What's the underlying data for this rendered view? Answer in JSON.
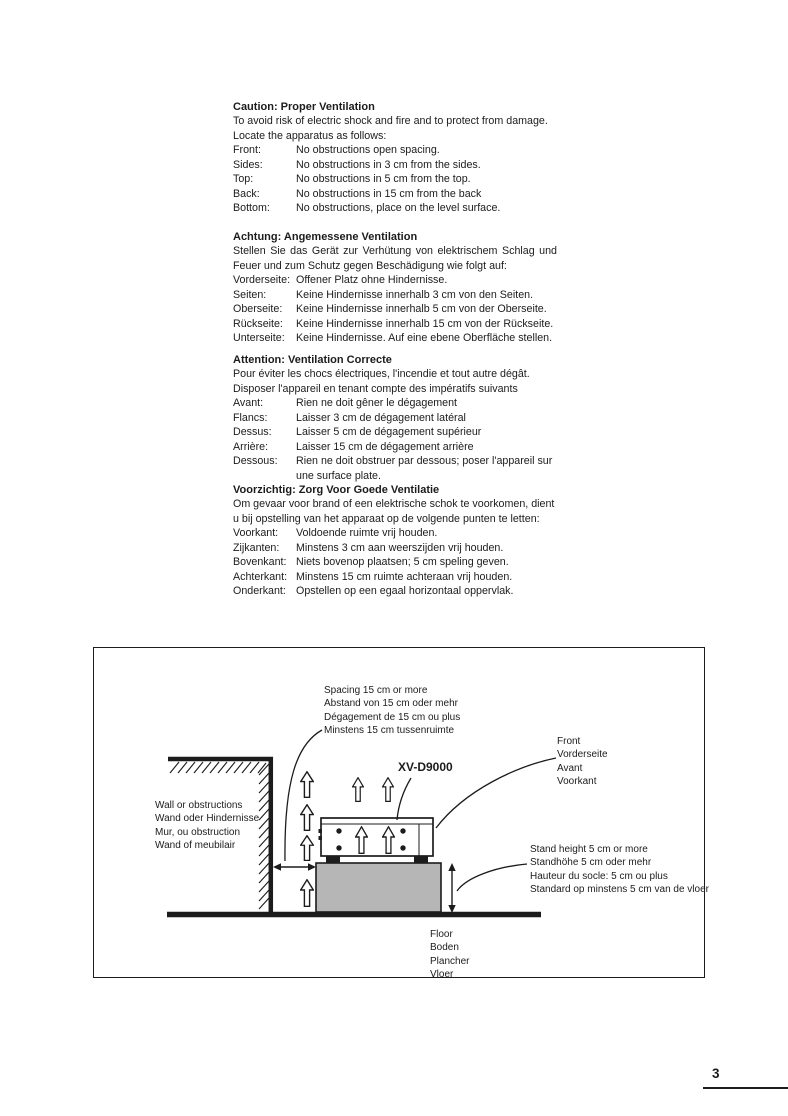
{
  "page": {
    "number": "3"
  },
  "sections": [
    {
      "heading": "Caution: Proper Ventilation",
      "intro": [
        "To avoid risk of electric shock and fire and to protect from damage.",
        "Locate the apparatus as follows:"
      ],
      "rows": [
        {
          "label": "Front:",
          "text": "No obstructions open spacing."
        },
        {
          "label": "Sides:",
          "text": "No obstructions in 3 cm from the sides."
        },
        {
          "label": "Top:",
          "text": "No obstructions in 5 cm from the top."
        },
        {
          "label": "Back:",
          "text": "No obstructions in 15 cm from the back"
        },
        {
          "label": "Bottom:",
          "text": "No obstructions, place on the level surface."
        }
      ]
    },
    {
      "heading": "Achtung: Angemessene Ventilation",
      "intro": [
        "Stellen Sie das Gerät zur Verhütung von elektrischem Schlag und",
        "Feuer und zum Schutz gegen Beschädigung wie folgt auf:"
      ],
      "rows": [
        {
          "label": "Vorderseite:",
          "text": "Offener Platz ohne Hindernisse."
        },
        {
          "label": "Seiten:",
          "text": "Keine Hindernisse innerhalb 3 cm von den Seiten."
        },
        {
          "label": "Oberseite:",
          "text": "Keine Hindernisse innerhalb 5 cm von der Oberseite."
        },
        {
          "label": "Rückseite:",
          "text": "Keine Hindernisse innerhalb 15 cm von der Rückseite."
        },
        {
          "label": "Unterseite:",
          "text": "Keine Hindernisse.  Auf eine ebene Oberfläche stellen."
        }
      ]
    },
    {
      "heading": "Attention: Ventilation Correcte",
      "intro": [
        "Pour éviter les chocs électriques, l'incendie et tout autre dégât.",
        "Disposer l'appareil en tenant compte des impératifs suivants"
      ],
      "rows": [
        {
          "label": "Avant:",
          "text": "Rien ne doit gêner le dégagement"
        },
        {
          "label": "Flancs:",
          "text": "Laisser 3 cm de dégagement latéral"
        },
        {
          "label": "Dessus:",
          "text": "Laisser 5 cm de dégagement supérieur"
        },
        {
          "label": "Arrière:",
          "text": "Laisser 15 cm de dégagement arrière"
        },
        {
          "label": "Dessous:",
          "text": "Rien ne doit obstruer par dessous; poser l'appareil sur",
          "text2": "une surface plate."
        }
      ]
    },
    {
      "heading": "Voorzichtig: Zorg Voor Goede Ventilatie",
      "intro": [
        "Om gevaar voor brand of een elektrische schok te voorkomen, dient",
        "u bij opstelling van het apparaat op de volgende punten te letten:"
      ],
      "rows": [
        {
          "label": "Voorkant:",
          "text": "Voldoende ruimte vrij houden."
        },
        {
          "label": "Zijkanten:",
          "text": "Minstens 3 cm aan weerszijden vrij houden."
        },
        {
          "label": "Bovenkant:",
          "text": "Niets bovenop plaatsen; 5 cm speling geven."
        },
        {
          "label": "Achterkant:",
          "text": "Minstens 15 cm ruimte achteraan vrij houden."
        },
        {
          "label": "Onderkant:",
          "text": "Opstellen op een egaal horizontaal oppervlak."
        }
      ]
    }
  ],
  "diagram": {
    "model": "XV-D9000",
    "spacing_label": [
      "Spacing 15 cm or more",
      "Abstand von 15 cm oder mehr",
      "Dégagement de 15 cm ou plus",
      "Minstens 15 cm tussenruimte"
    ],
    "front_label": [
      "Front",
      "Vorderseite",
      "Avant",
      "Voorkant"
    ],
    "wall_label": [
      "Wall or obstructions",
      "Wand oder Hindernisse",
      "Mur, ou obstruction",
      "Wand of meubilair"
    ],
    "stand_label": [
      "Stand height 5 cm or more",
      "Standhöhe 5 cm oder mehr",
      "Hauteur du socle: 5 cm ou plus",
      "Standard op minstens 5 cm van de vloer"
    ],
    "floor_label": [
      "Floor",
      "Boden",
      "Plancher",
      "Vloer"
    ],
    "ink_color": "#1c1c1c",
    "stand_fill": "#b6b6b6"
  }
}
